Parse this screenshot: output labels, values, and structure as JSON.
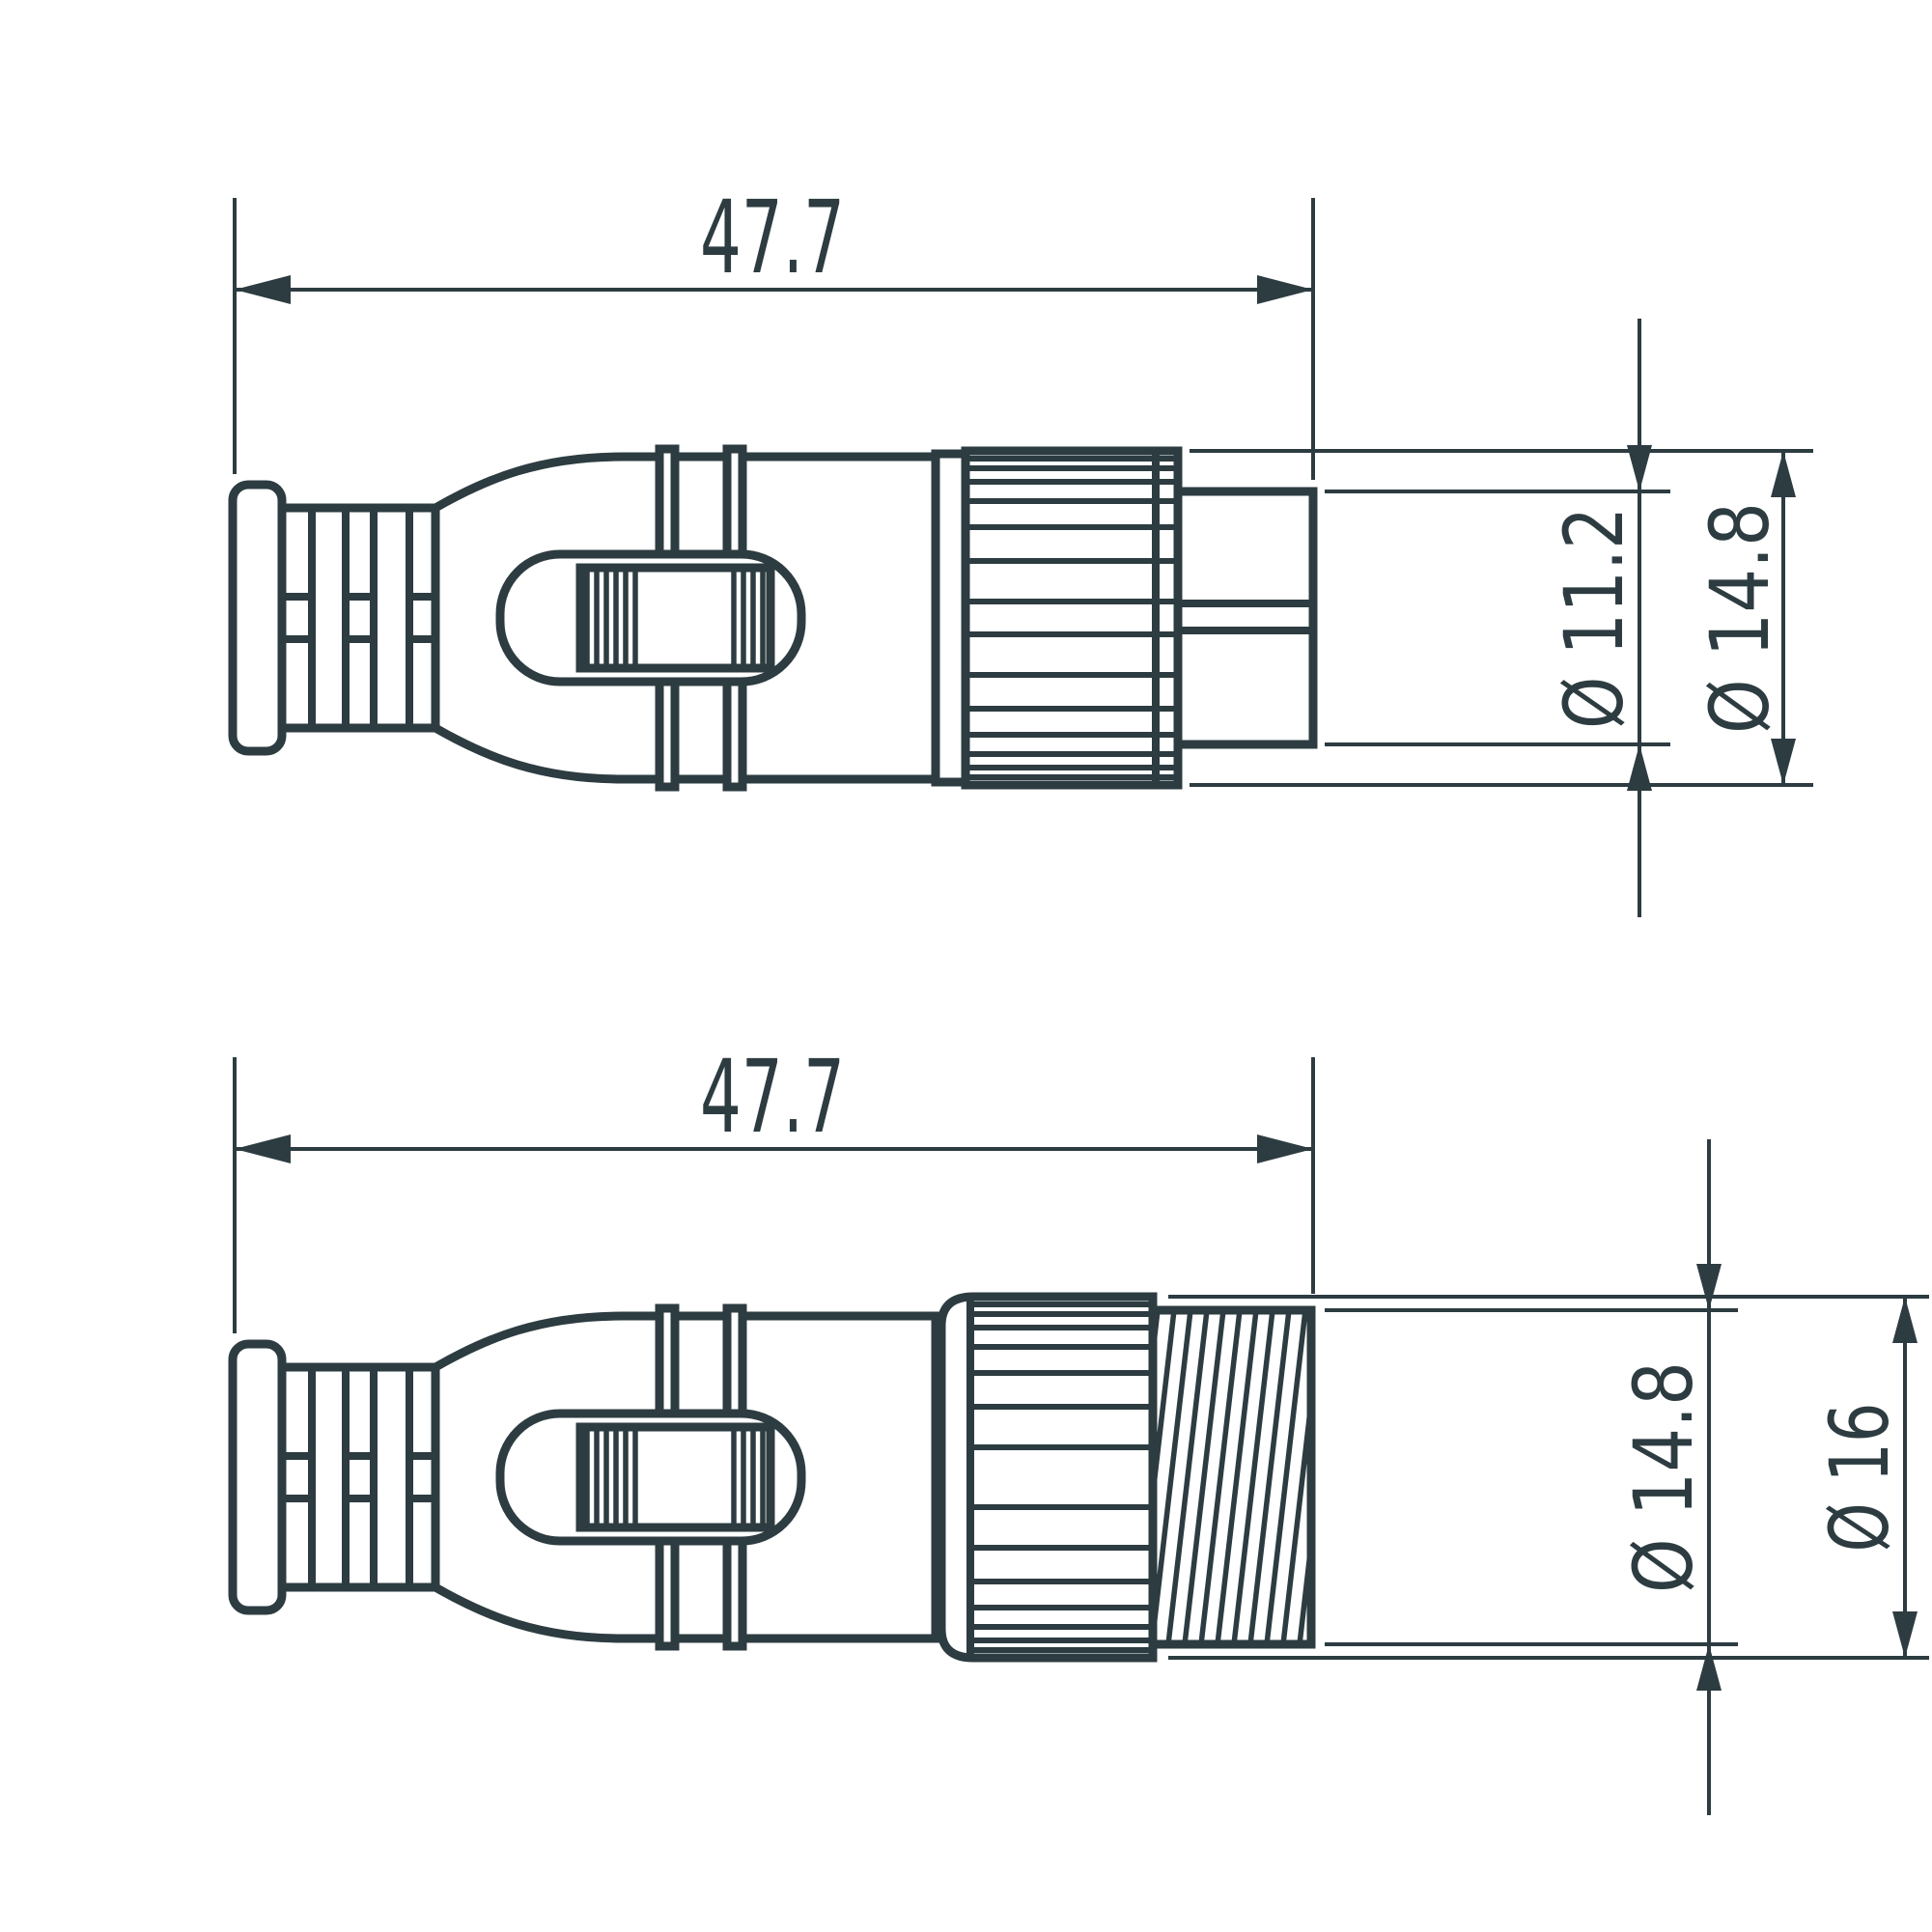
{
  "drawing": {
    "stroke_color": "#2d3c41",
    "background_color": "#ffffff",
    "views": [
      {
        "id": "top",
        "length_label": "47.7",
        "inner_diameter_label": "Ø 11.2",
        "outer_diameter_label": "Ø 14.8"
      },
      {
        "id": "bottom",
        "length_label": "47.7",
        "inner_diameter_label": "Ø 14.8",
        "outer_diameter_label": "Ø 16"
      }
    ]
  }
}
